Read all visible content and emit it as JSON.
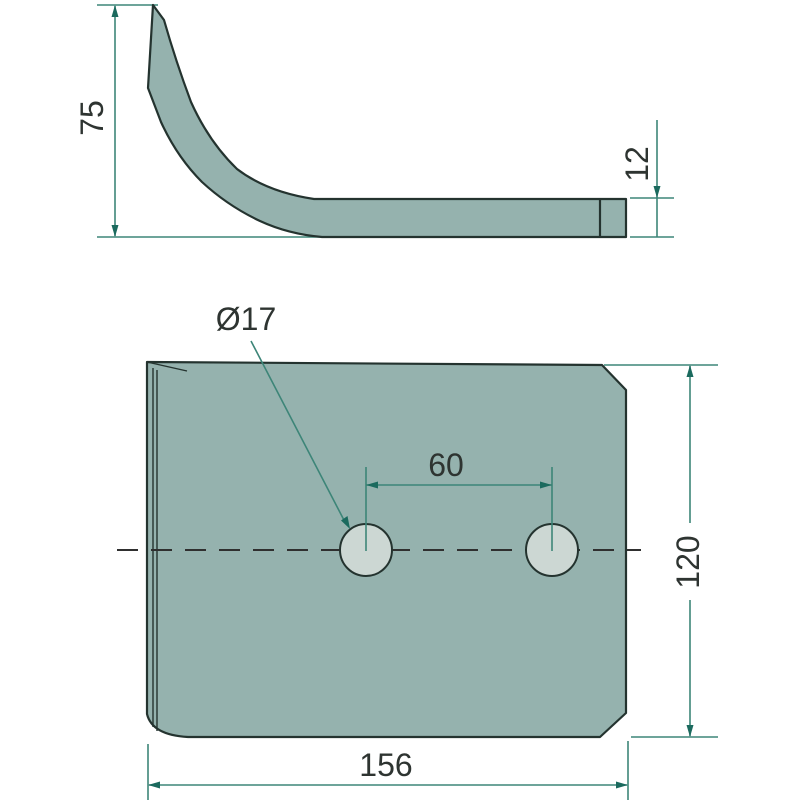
{
  "colors": {
    "background": "#ffffff",
    "part_fill": "#95b2ae",
    "hole_fill": "#ccd7d3",
    "outline": "#24332f",
    "centerline": "#2f2f2f",
    "dim_line": "#3d8578",
    "dim_arrow": "#1b6a5e",
    "text": "#2e3431"
  },
  "side_view": {
    "dim_height": "75",
    "dim_thickness": "12"
  },
  "front_view": {
    "dim_hole_diameter": "Ø17",
    "dim_hole_spacing": "60",
    "dim_height": "120",
    "dim_width": "156"
  }
}
